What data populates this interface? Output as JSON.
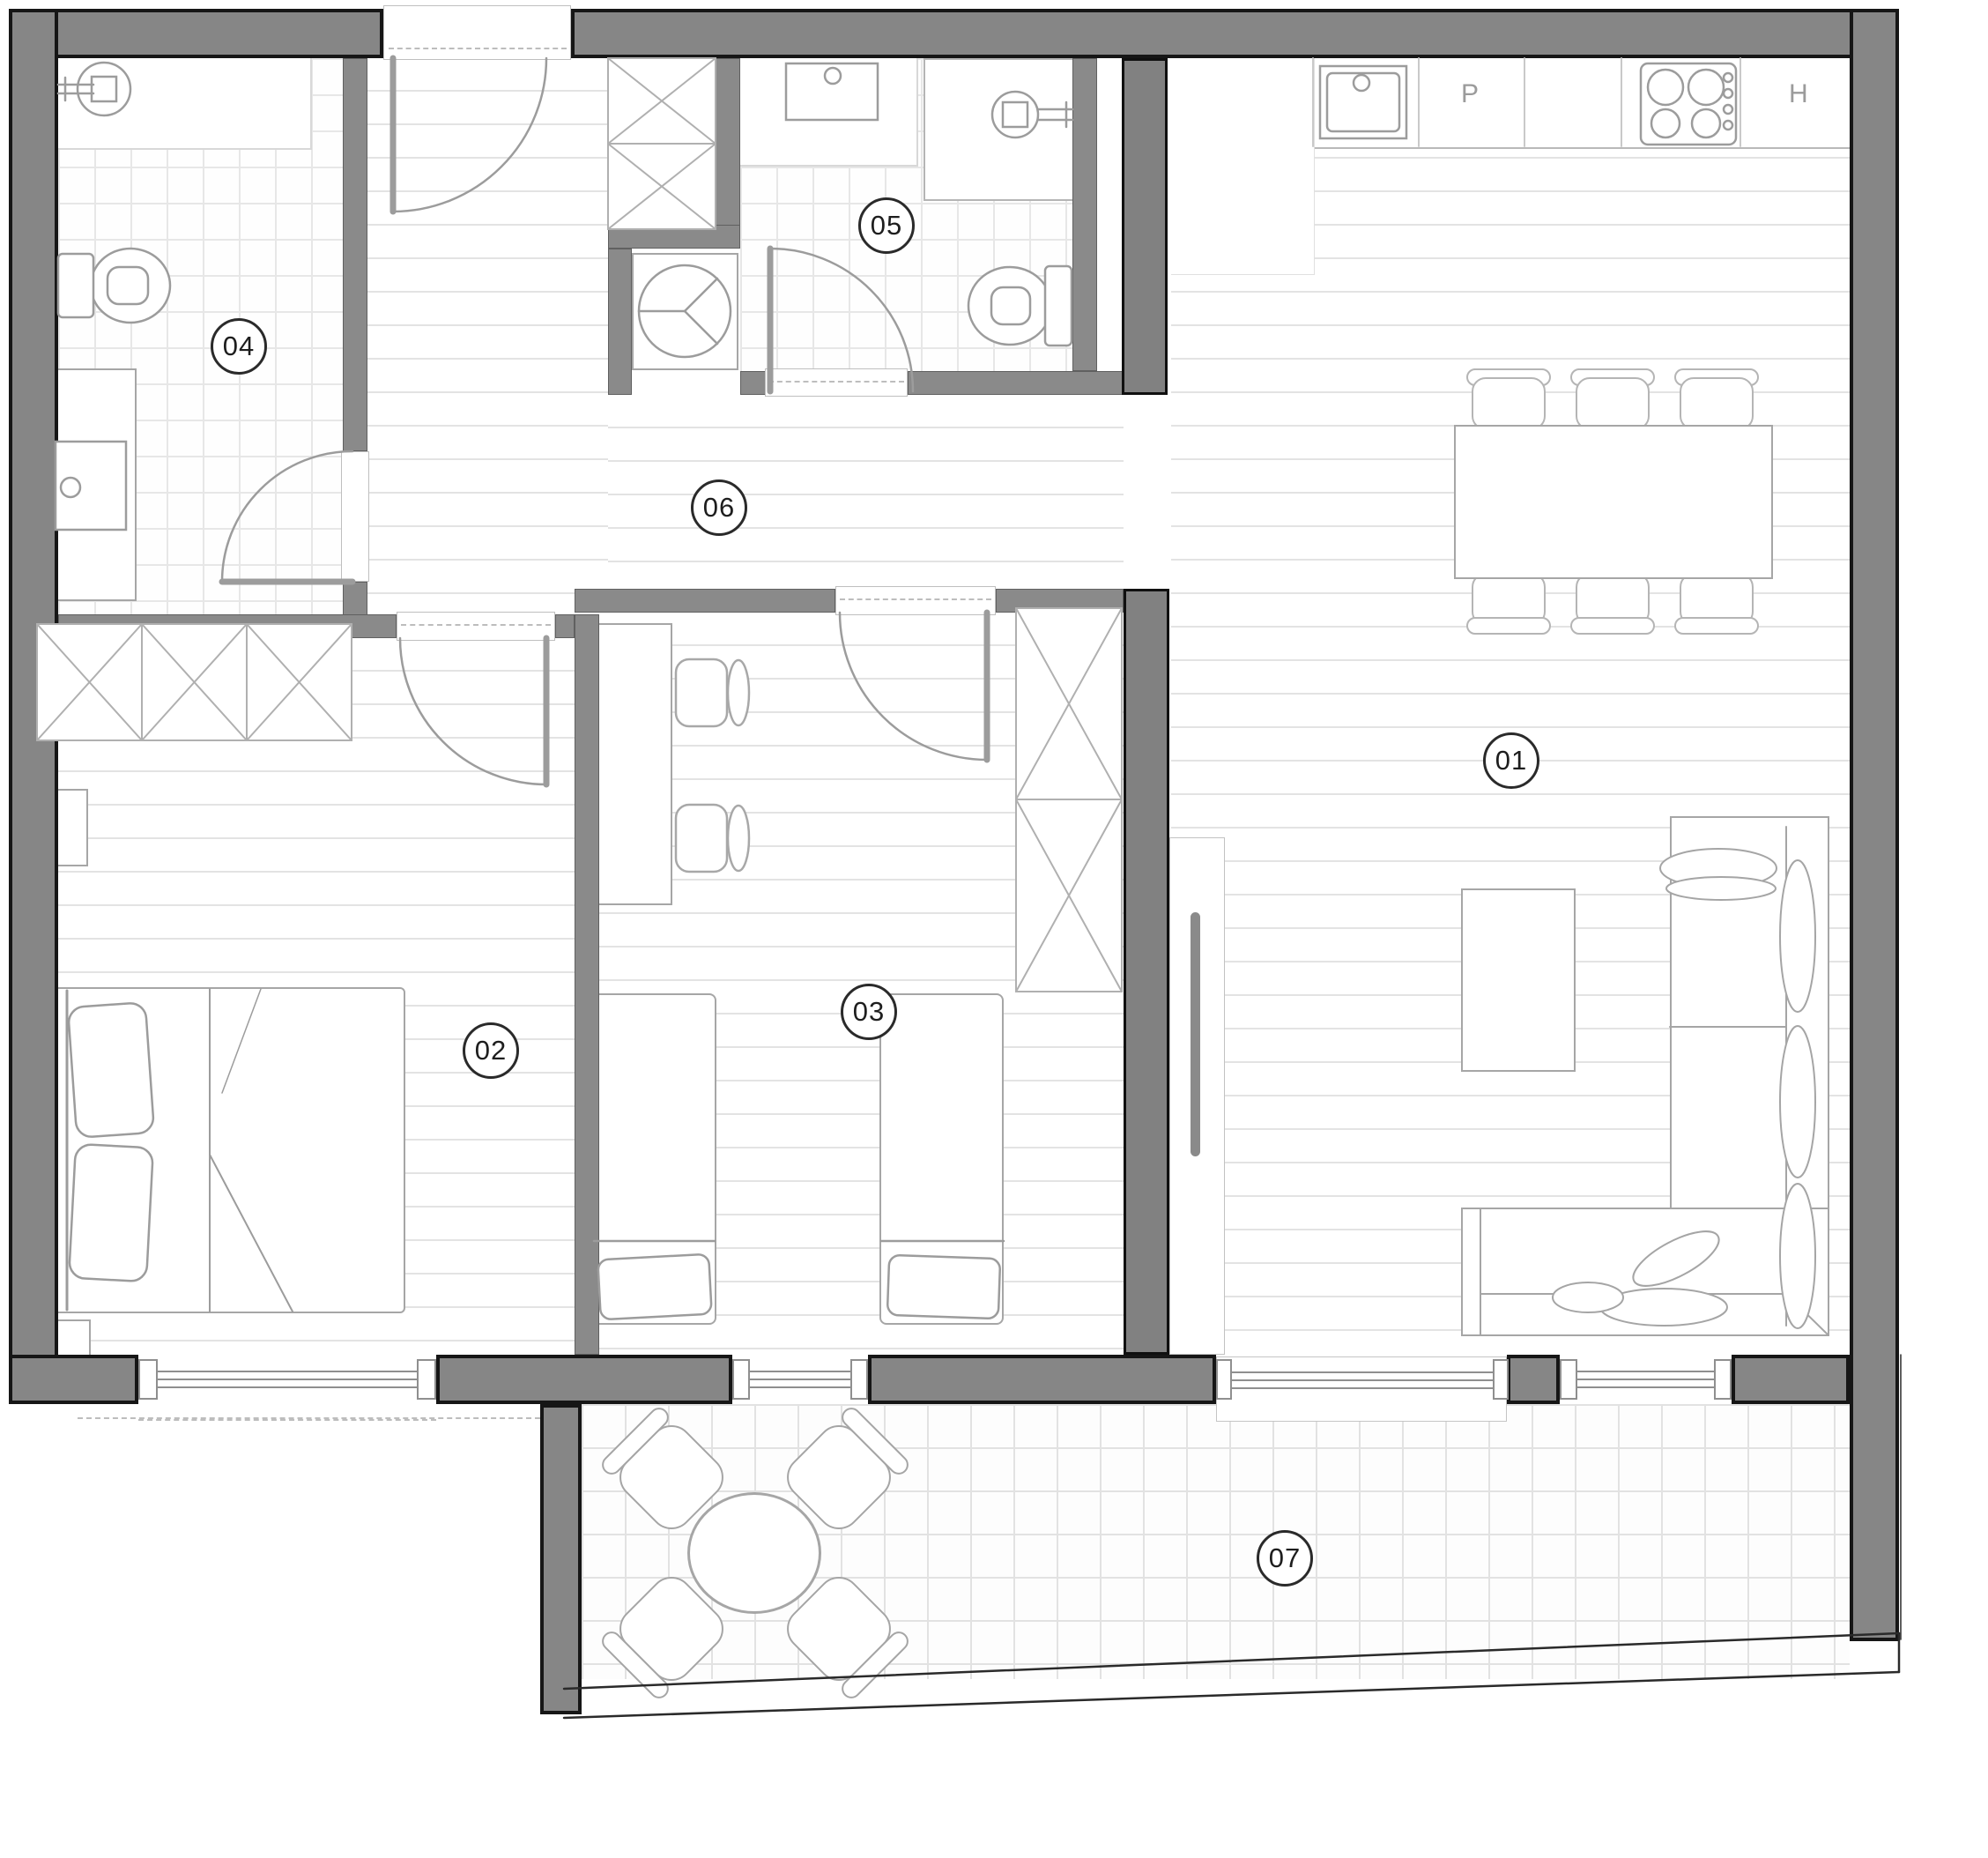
{
  "plan": {
    "kind": "apartment floor plan drawing",
    "colors": {
      "wall_fill": "#868686",
      "wall_edge": "#161616",
      "line_art": "#9c9c9c",
      "floor_line": "#e3e3e3",
      "label_border": "#2a2a2a"
    }
  },
  "room_labels": [
    {
      "text": "01"
    },
    {
      "text": "02"
    },
    {
      "text": "03"
    },
    {
      "text": "04"
    },
    {
      "text": "05"
    },
    {
      "text": "06"
    },
    {
      "text": "07"
    }
  ],
  "kitchen_labels": {
    "unit_p": "P",
    "unit_h": "H"
  }
}
